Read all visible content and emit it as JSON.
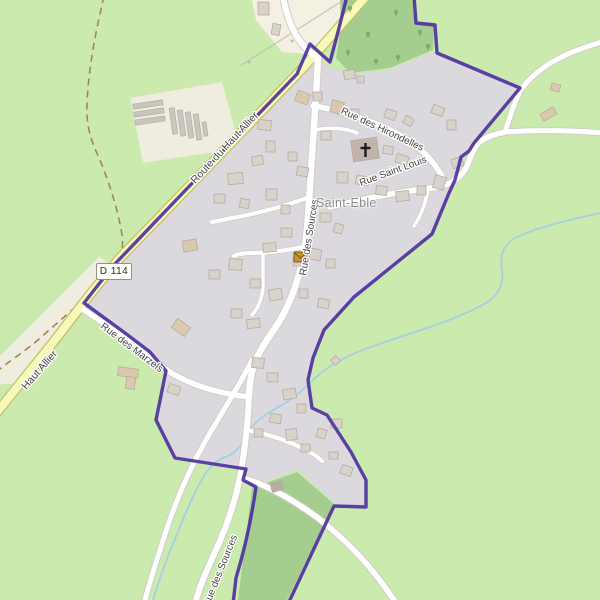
{
  "map": {
    "kind": "openstreetmap-village-view"
  },
  "place_label": {
    "text": "Saint-Eble"
  },
  "road_ref": {
    "label": "D 114"
  },
  "colors": {
    "background": "#cbeaae",
    "forest": "#a6cd90",
    "residential": "#dcd9de",
    "farmland": "#efece0",
    "farmland_light": "#f4f1e2",
    "road_fill": "#ffffff",
    "road_casing": "#cfcdc9",
    "yellow_road_fill": "#f7f9bb",
    "yellow_road_casing": "#c2c263",
    "boundary": "#4b2da1",
    "stream": "#a5cfe3",
    "track": "#a5854f",
    "building_fill": "#d9d2ca",
    "building_stroke": "#b5aca3",
    "building_tan": "#dbc9ad",
    "building_dark": "#b9aca2",
    "church_fill": "#c2b4ab",
    "greenhouse": "#c9c6be",
    "tree": "#7fab69",
    "label": "#454545",
    "power_line": "#bdbab2",
    "post_office_fill": "#c8922f",
    "post_office_stroke": "#7c5a17",
    "cross": "#1a1a1a"
  },
  "areas": [
    {
      "name": "farmland-field",
      "points": "130,98 222,82 240,148 143,163",
      "fill": "farmland"
    },
    {
      "name": "farmland-roadside-strip",
      "points": "100,256 112,268 15,384 0,384 0,356",
      "fill": "farmland"
    },
    {
      "name": "farmyard-top",
      "points": "252,0 363,0 308,54 282,52 256,20",
      "fill": "farmland_light"
    },
    {
      "name": "residential-village",
      "points": "313,56 330,68 350,74 390,70 433,51 518,88 470,146 452,183 432,234 353,297 323,330 313,357 307,378 311,407 325,414 350,452 366,481 366,506 336,504 298,470 255,485 247,470 175,460 157,420 167,370 84,303",
      "fill": "residential"
    },
    {
      "name": "forest-north",
      "points": "340,0 414,0 416,22 434,24 433,50 390,68 350,73 336,58 341,26",
      "fill": "forest"
    },
    {
      "name": "forest-south-corridor",
      "points": "252,488 297,472 334,504 287,600 238,600",
      "fill": "forest"
    }
  ],
  "tracks": [
    {
      "name": "dirt-track",
      "d": "M104,-4 C96,30 88,70 87,105 C86,128 92,143 100,160 C110,185 118,210 122,235 C124,252 120,262 112,272 C96,290 66,315 38,340 C20,355 8,362 -4,372",
      "width": 1.6,
      "dash": "7 5"
    }
  ],
  "power_line": {
    "d": "M350,-4 L240,66",
    "poles": [
      [
        292,
        41
      ],
      [
        249,
        62
      ]
    ]
  },
  "waterways": [
    {
      "name": "stream",
      "d": "M604,212 C570,220 540,226 515,238 C502,245 500,258 502,270 C504,284 498,296 486,303 C462,317 430,327 400,337 C370,347 345,355 325,370 C310,381 302,392 290,400 C275,410 260,415 250,430 C243,442 238,452 228,456 C215,460 208,468 200,483 C188,505 178,532 168,556 C160,578 155,592 152,604",
      "width": 1.8
    }
  ],
  "roads": [
    {
      "name": "route-du-haut-allier-road",
      "d": "M368,-6 L303,68 L206,169 L118,260 L88,297 L55,340 L-6,416",
      "width": 8,
      "casing": 10.5,
      "type": "yellow"
    },
    {
      "name": "top-access-road",
      "d": "M283,-4 C288,25 298,45 318,58",
      "width": 6,
      "casing": 8,
      "type": "white"
    },
    {
      "name": "rue-des-sources-road",
      "d": "M318,58 C316,100 313,140 311,170 C309,200 308,228 304,252 C299,280 291,302 279,322 C267,340 258,352 253,368 C250,380 249,390 249,397",
      "width": 6.5,
      "casing": 8.5,
      "type": "white"
    },
    {
      "name": "rue-des-sources-south-road",
      "d": "M249,397 C247,436 243,462 239,482 C234,505 226,528 215,552 C206,572 199,588 195,604",
      "width": 6,
      "casing": 8,
      "type": "white"
    },
    {
      "name": "rue-des-hirondelles-road",
      "d": "M313,106 C342,110 372,121 398,134 C418,145 432,158 443,178",
      "width": 5.5,
      "casing": 7.5,
      "type": "white"
    },
    {
      "name": "rue-saint-louis-road",
      "d": "M330,207 C365,198 405,191 432,188 C448,186 458,180 465,170 C470,160 472,152 476,146 C482,138 492,135 505,132",
      "width": 5.5,
      "casing": 7.5,
      "type": "white"
    },
    {
      "name": "country-road-east",
      "d": "M505,132 C535,130 565,130 604,133",
      "width": 5,
      "casing": 7,
      "type": "white"
    },
    {
      "name": "country-road-northeast",
      "d": "M505,132 C512,110 516,98 522,88 C536,70 556,58 578,50 C588,46 598,43 606,41",
      "width": 5,
      "casing": 7,
      "type": "white"
    },
    {
      "name": "rue-des-marzels-road",
      "d": "M84,310 C105,324 135,344 160,365 C172,375 188,383 212,390 C228,394 240,396 249,397",
      "width": 5.5,
      "casing": 7.5,
      "type": "white"
    },
    {
      "name": "southwest-road",
      "d": "M252,360 C240,385 222,412 206,440 C190,468 177,498 167,528 C158,556 150,580 144,604",
      "width": 5,
      "casing": 7,
      "type": "white"
    },
    {
      "name": "southeast-road",
      "d": "M243,478 C268,485 293,500 318,518 C341,536 362,557 378,578 C387,590 393,598 398,606",
      "width": 5.5,
      "casing": 7.5,
      "type": "white"
    },
    {
      "name": "lane-west",
      "d": "M307,198 C282,207 258,213 238,217 C226,219 218,221 212,222",
      "width": 4,
      "casing": 5.5,
      "type": "white"
    },
    {
      "name": "lane-center",
      "d": "M303,247 C283,251 265,253 252,253 C244,253 238,254 234,256",
      "width": 4,
      "casing": 5.5,
      "type": "white"
    },
    {
      "name": "lane-center-south",
      "d": "M263,253 L263,283 C263,297 259,307 252,315",
      "width": 3.5,
      "casing": 5,
      "type": "white"
    },
    {
      "name": "lane-church",
      "d": "M314,130 C332,127 346,128 357,133",
      "width": 3.5,
      "casing": 5,
      "type": "white"
    },
    {
      "name": "lane-south-cluster",
      "d": "M246,430 C268,434 288,441 304,449 C312,453 318,457 322,461",
      "width": 4,
      "casing": 5.5,
      "type": "white"
    },
    {
      "name": "lane-east-short",
      "d": "M428,189 C426,202 422,214 414,226",
      "width": 3.5,
      "casing": 5,
      "type": "white"
    }
  ],
  "boundary": {
    "name": "commune-boundary",
    "width": 3.4,
    "opacity": 0.9,
    "paths": [
      "M347,-4 L339,28 L330,62 L310,44 L297,74 L200,175 L113,266 L84,303 L125,333 L150,352 L166,371 L156,420 L175,458 L246,469 L243,480 L256,487 C252,515 246,545 236,578 L233,604",
      "M288,604 L334,506 L366,507 L366,480 L351,452 L327,415 L312,408 L308,380 L313,358 L324,330 L354,297 L432,234 L449,193 L455,180 L461,157 L469,151 L474,143 L520,88 L437,53 L435,25 L416,23 L414,-4"
    ]
  },
  "greenhouses": [
    [
      133,
      102,
      30,
      5,
      -8
    ],
    [
      134,
      110,
      30,
      5,
      -8
    ],
    [
      135,
      118,
      30,
      5,
      -8
    ],
    [
      171,
      108,
      5,
      26,
      -8
    ],
    [
      179,
      110,
      5,
      26,
      -8
    ],
    [
      187,
      112,
      5,
      26,
      -8
    ],
    [
      195,
      114,
      5,
      26,
      -8
    ],
    [
      203,
      122,
      4,
      14,
      -8
    ]
  ],
  "buildings": [
    [
      258,
      2,
      11,
      13,
      0,
      "g"
    ],
    [
      272,
      24,
      8,
      11,
      10,
      "g"
    ],
    [
      344,
      70,
      11,
      9,
      -10,
      "g"
    ],
    [
      357,
      76,
      7,
      7,
      0,
      "g"
    ],
    [
      296,
      92,
      13,
      11,
      20,
      "t"
    ],
    [
      313,
      92,
      9,
      9,
      0,
      "g"
    ],
    [
      331,
      101,
      12,
      12,
      15,
      "t"
    ],
    [
      350,
      109,
      9,
      8,
      0,
      "g"
    ],
    [
      385,
      110,
      11,
      9,
      20,
      "g"
    ],
    [
      404,
      117,
      9,
      8,
      30,
      "g"
    ],
    [
      432,
      106,
      12,
      9,
      20,
      "g"
    ],
    [
      447,
      120,
      9,
      10,
      0,
      "g"
    ],
    [
      321,
      131,
      10,
      9,
      0,
      "g"
    ],
    [
      383,
      146,
      10,
      8,
      10,
      "g"
    ],
    [
      396,
      155,
      12,
      9,
      20,
      "g"
    ],
    [
      258,
      120,
      13,
      10,
      5,
      "g"
    ],
    [
      266,
      141,
      9,
      11,
      0,
      "g"
    ],
    [
      252,
      156,
      11,
      9,
      -10,
      "g"
    ],
    [
      288,
      152,
      9,
      9,
      0,
      "g"
    ],
    [
      297,
      167,
      11,
      9,
      10,
      "g"
    ],
    [
      337,
      172,
      11,
      11,
      0,
      "g"
    ],
    [
      356,
      176,
      13,
      9,
      10,
      "g"
    ],
    [
      376,
      186,
      11,
      9,
      5,
      "g"
    ],
    [
      396,
      191,
      13,
      10,
      -5,
      "g"
    ],
    [
      417,
      186,
      9,
      9,
      0,
      "g"
    ],
    [
      434,
      176,
      11,
      13,
      15,
      "g"
    ],
    [
      452,
      158,
      11,
      9,
      -20,
      "g"
    ],
    [
      228,
      173,
      15,
      11,
      -5,
      "g"
    ],
    [
      214,
      194,
      11,
      9,
      0,
      "g"
    ],
    [
      240,
      199,
      9,
      9,
      10,
      "g"
    ],
    [
      266,
      189,
      11,
      11,
      0,
      "g"
    ],
    [
      281,
      205,
      9,
      9,
      0,
      "g"
    ],
    [
      183,
      240,
      14,
      11,
      -10,
      "t"
    ],
    [
      320,
      213,
      11,
      9,
      0,
      "g"
    ],
    [
      334,
      224,
      9,
      9,
      15,
      "g"
    ],
    [
      281,
      228,
      11,
      9,
      0,
      "g"
    ],
    [
      263,
      243,
      13,
      9,
      -5,
      "g"
    ],
    [
      293,
      258,
      10,
      8,
      0,
      "g"
    ],
    [
      310,
      249,
      11,
      11,
      10,
      "g"
    ],
    [
      326,
      259,
      9,
      9,
      0,
      "g"
    ],
    [
      229,
      259,
      13,
      11,
      5,
      "g"
    ],
    [
      209,
      270,
      11,
      9,
      0,
      "g"
    ],
    [
      250,
      279,
      11,
      9,
      0,
      "g"
    ],
    [
      269,
      289,
      13,
      11,
      -10,
      "g"
    ],
    [
      299,
      289,
      9,
      9,
      0,
      "g"
    ],
    [
      318,
      299,
      11,
      9,
      10,
      "g"
    ],
    [
      231,
      309,
      11,
      9,
      0,
      "g"
    ],
    [
      247,
      319,
      13,
      9,
      -5,
      "g"
    ],
    [
      173,
      322,
      16,
      11,
      35,
      "t"
    ],
    [
      118,
      368,
      20,
      9,
      8,
      "t"
    ],
    [
      126,
      377,
      9,
      12,
      8,
      "t"
    ],
    [
      168,
      385,
      12,
      9,
      20,
      "g"
    ],
    [
      252,
      358,
      12,
      10,
      5,
      "g"
    ],
    [
      267,
      373,
      11,
      9,
      0,
      "g"
    ],
    [
      283,
      389,
      13,
      10,
      -10,
      "g"
    ],
    [
      297,
      404,
      9,
      9,
      0,
      "g"
    ],
    [
      270,
      414,
      11,
      9,
      10,
      "g"
    ],
    [
      254,
      429,
      9,
      8,
      0,
      "g"
    ],
    [
      286,
      429,
      11,
      11,
      -5,
      "g"
    ],
    [
      301,
      444,
      9,
      8,
      0,
      "g"
    ],
    [
      317,
      429,
      9,
      9,
      15,
      "g"
    ],
    [
      331,
      419,
      11,
      9,
      0,
      "g"
    ],
    [
      329,
      452,
      9,
      7,
      0,
      "g"
    ],
    [
      341,
      466,
      11,
      9,
      20,
      "g"
    ],
    [
      332,
      357,
      7,
      7,
      45,
      "g"
    ],
    [
      271,
      482,
      12,
      9,
      -15,
      "d"
    ],
    [
      551,
      84,
      9,
      7,
      15,
      "t"
    ],
    [
      541,
      110,
      15,
      8,
      -30,
      "t"
    ]
  ],
  "trees": [
    [
      350,
      8
    ],
    [
      396,
      12
    ],
    [
      420,
      32
    ],
    [
      368,
      34
    ],
    [
      348,
      52
    ],
    [
      398,
      57
    ],
    [
      428,
      46
    ],
    [
      376,
      61
    ]
  ],
  "church": {
    "name": "church",
    "x": 352,
    "y": 139,
    "w": 26,
    "h": 21,
    "rot": -8,
    "cross_x": 365.5,
    "cross_y": 150
  },
  "post_office": {
    "name": "post-office",
    "x": 294,
    "y": 252,
    "w": 13,
    "h": 10
  },
  "road_labels": [
    {
      "name": "label-route-du-haut-allier",
      "text": "Route du Haut Allier",
      "x": 227,
      "y": 150,
      "rotate": -47,
      "size": 10.5
    },
    {
      "name": "label-haut-allier",
      "text": "Haut Allier",
      "x": 42,
      "y": 372,
      "rotate": -49,
      "size": 10.5
    },
    {
      "name": "label-rue-des-hirondelles",
      "text": "Rue des Hirondelles",
      "x": 381,
      "y": 132,
      "rotate": 25,
      "size": 10
    },
    {
      "name": "label-rue-saint-louis",
      "text": "Rue Saint Louis",
      "x": 394,
      "y": 174,
      "rotate": -20,
      "size": 10
    },
    {
      "name": "label-rue-des-sources-north",
      "text": "Rue des Sources",
      "x": 312,
      "y": 238,
      "rotate": -81,
      "size": 10
    },
    {
      "name": "label-rue-des-marzels",
      "text": "Rue des Marzels",
      "x": 130,
      "y": 350,
      "rotate": 37,
      "size": 10
    },
    {
      "name": "label-rue-des-sources-south",
      "text": "Rue des Sources",
      "x": 223,
      "y": 572,
      "rotate": -68,
      "size": 10
    }
  ]
}
